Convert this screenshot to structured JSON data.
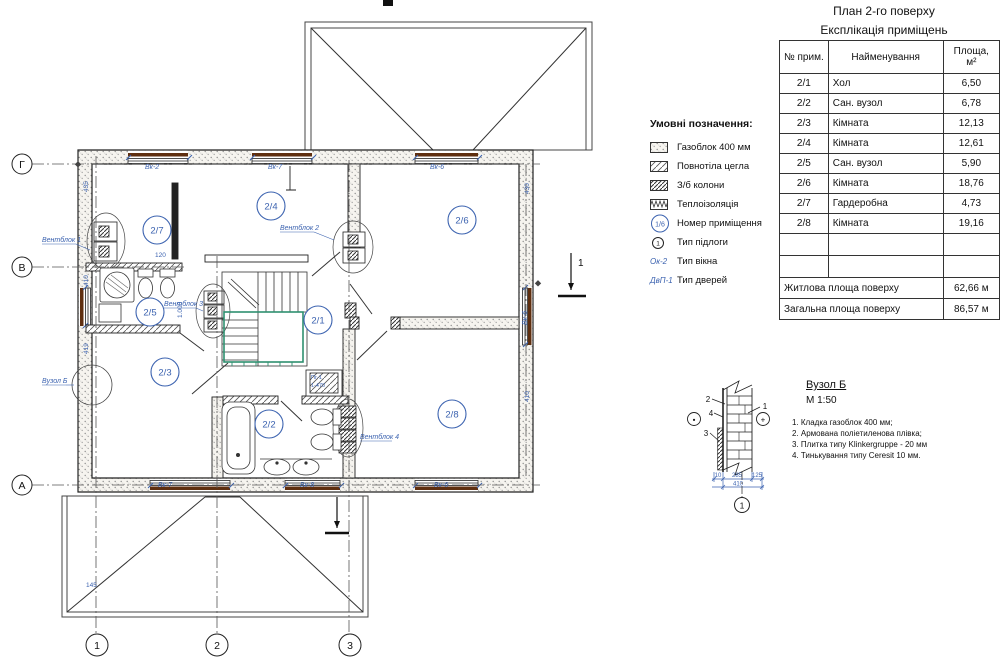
{
  "sheet": {
    "title_line1": "План 2-го поверху",
    "title_line2": "Експлікація приміщень"
  },
  "table": {
    "col_num": "№ прим.",
    "col_name": "Найменування",
    "col_area_1": "Площа,",
    "col_area_2": "м²",
    "rows": [
      {
        "num": "2/1",
        "name": "Хол",
        "area": "6,50"
      },
      {
        "num": "2/2",
        "name": "Сан. вузол",
        "area": "6,78"
      },
      {
        "num": "2/3",
        "name": "Кімната",
        "area": "12,13"
      },
      {
        "num": "2/4",
        "name": "Кімната",
        "area": "12,61"
      },
      {
        "num": "2/5",
        "name": "Сан. вузол",
        "area": "5,90"
      },
      {
        "num": "2/6",
        "name": "Кімната",
        "area": "18,76"
      },
      {
        "num": "2/7",
        "name": "Гардеробна",
        "area": "4,73"
      },
      {
        "num": "2/8",
        "name": "Кімната",
        "area": "19,16"
      }
    ],
    "total_living_label": "Житлова площа поверху",
    "total_living_value": "62,66 м",
    "total_overall_label": "Загальна площа поверху",
    "total_overall_value": "86,57 м"
  },
  "legend": {
    "title": "Умовні позначення:",
    "item1": "Газоблок 400 мм",
    "item2": "Повнотіла цегла",
    "item3": "З/б колони",
    "item4": "Теплоізоляція",
    "item5": "Номер приміщення",
    "item6": "Тип підлоги",
    "item7": "Тип вікна",
    "item8": "Тип дверей",
    "sym_room": "1/6",
    "sym_floor": "1",
    "sym_window": "Ок-2",
    "sym_door": "ДвП-1"
  },
  "plan": {
    "rooms": {
      "r21": "2/1",
      "r22": "2/2",
      "r23": "2/3",
      "r24": "2/4",
      "r25": "2/5",
      "r26": "2/6",
      "r27": "2/7",
      "r28": "2/8"
    },
    "vb1": "Вентблок 1",
    "vb2": "Вентблок 2",
    "vb3": "Вентблок 3",
    "vb4": "Вентблок 4",
    "node_ref": "Вузол Б",
    "win": {
      "t1": "Вк-2",
      "t2": "Вк-7",
      "t3": "Вк-6",
      "b1": "Вк-7",
      "b2": "Вк-8",
      "b3": "Вк-6",
      "r1": "Вк-6"
    },
    "shaft1": "Пг-1",
    "shaft2": "1-470",
    "dims": {
      "d435": "435",
      "d410": "410",
      "d419": "419",
      "d145": "145",
      "d430": "430",
      "d410b": "410",
      "d120": "120",
      "d1000": "1.000"
    },
    "axis": {
      "g": "Г",
      "v": "В",
      "a": "А",
      "n1": "1",
      "n2": "2",
      "n3": "3"
    },
    "section": "1"
  },
  "detail": {
    "title": "Вузол Б",
    "scale": "М 1:50",
    "note1": "1. Кладка газоблок 400 мм;",
    "note2": "2. Армована поліетиленова плівка;",
    "note3": "3. Плитка типу Klinkergruppe  - 20 мм",
    "note4": "4. Тинькування типу Ceresit 10 мм.",
    "c1": "1",
    "c2": "2",
    "c3": "3",
    "c4": "4",
    "dim1": "10",
    "dim2": "285",
    "dim3": "125",
    "dim4": "410",
    "axis1": "1",
    "plus": "+",
    "minus": "•"
  }
}
